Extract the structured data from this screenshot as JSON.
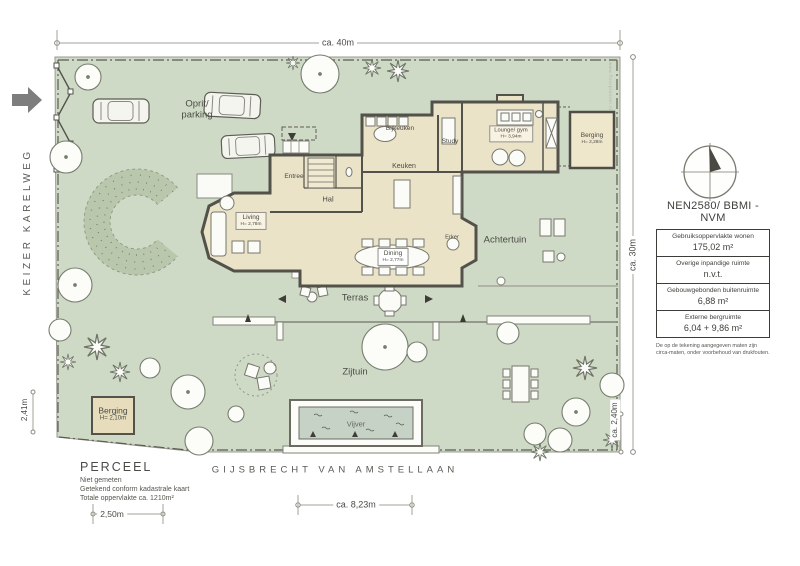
{
  "plan": {
    "streets": {
      "left": "KEIZER KARELWEG",
      "bottom": "GIJSBRECHT VAN AMSTELLAAN"
    },
    "dimensions": {
      "top": "ca. 40m",
      "right": "ca. 30m",
      "right_lower": "ca. 2,40m",
      "left_lower": "2,41m",
      "shed": "2,50m",
      "bottom": "ca. 8,23m"
    },
    "garden": {
      "driveway_line1": "Oprit/",
      "driveway_line2": "parking",
      "back": "Achtertuin",
      "terrace": "Terras",
      "side": "Zijtuin",
      "pond": "Vijver"
    },
    "rooms": {
      "entree": "Entree",
      "hal": "Hal",
      "keuken": "Keuken",
      "bijkeuken": "Bijkeuken",
      "study": "Study",
      "lounge": {
        "name": "Lounge/ gym",
        "height": "H= 3,94m"
      },
      "living": {
        "name": "Living",
        "height": "H= 2,78m"
      },
      "dining": {
        "name": "Dining",
        "height": "H= 2,77m"
      },
      "erker": "Erker",
      "berging_attached": {
        "name": "Berging",
        "height": "H= 2,28m"
      },
      "shed": {
        "name": "Berging",
        "height": "H= 2,10m"
      }
    },
    "parcel": {
      "title": "PERCEEL",
      "lines": [
        "Niet gemeten",
        "Getekend conform kadastrale kaart",
        "Totale oppervlakte ca. 1210m²"
      ]
    },
    "nen": {
      "title": "NEN2580/ BBMI - NVM",
      "rows": [
        {
          "label": "Gebruiksoppervlakte wonen",
          "value": "175,02 m²"
        },
        {
          "label": "Overige inpandige ruimte",
          "value": "n.v.t."
        },
        {
          "label": "Gebouwgebonden buitenruimte",
          "value": "6,88 m²"
        },
        {
          "label": "Externe bergruimte",
          "value": "6,04 + 9,86 m²"
        }
      ],
      "footnote": "De op de tekening aangegeven maten zijn circa-maten, onder voorbehoud van drukfouten."
    },
    "watermark": "www.floorplanner.nl",
    "colors": {
      "plot_green": "#cfdac6",
      "house_beige": "#ebe3c8",
      "wall": "#52524a",
      "arrow_gray": "#7d7d7d",
      "water": "#c7d2c6"
    }
  }
}
